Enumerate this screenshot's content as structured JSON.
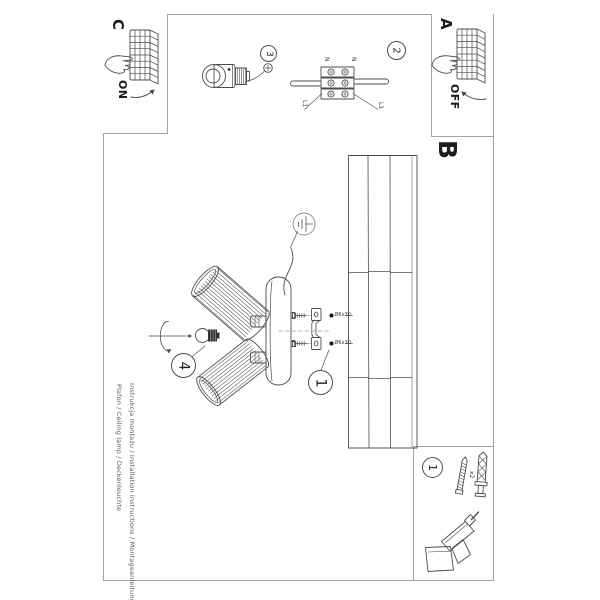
{
  "page": {
    "background": "#ffffff",
    "frame_color": "#a3a3a3",
    "ink": "#4d4d4d"
  },
  "section_c": {
    "label": "C",
    "state": "ON"
  },
  "section_a": {
    "label": "A",
    "state": "OFF"
  },
  "section_b": {
    "label": "B"
  },
  "steps": {
    "step_1": "1",
    "step_2": "2",
    "step_3": "3",
    "step_4": "4"
  },
  "parts_box": {
    "step": "1",
    "quantity": "x2"
  },
  "wiring": {
    "n_left": "N",
    "n_right": "N",
    "l1_left": "L1",
    "l1_right": "L1"
  },
  "screw_specs": {
    "top": "Ø6x30",
    "bottom": "Ø6x30"
  },
  "footer": {
    "line1": "Instrukcja montażu / Installation instructions / Montageanleitung",
    "line2": "Plafon / Ceiling lamp / Deckenleuchte"
  }
}
